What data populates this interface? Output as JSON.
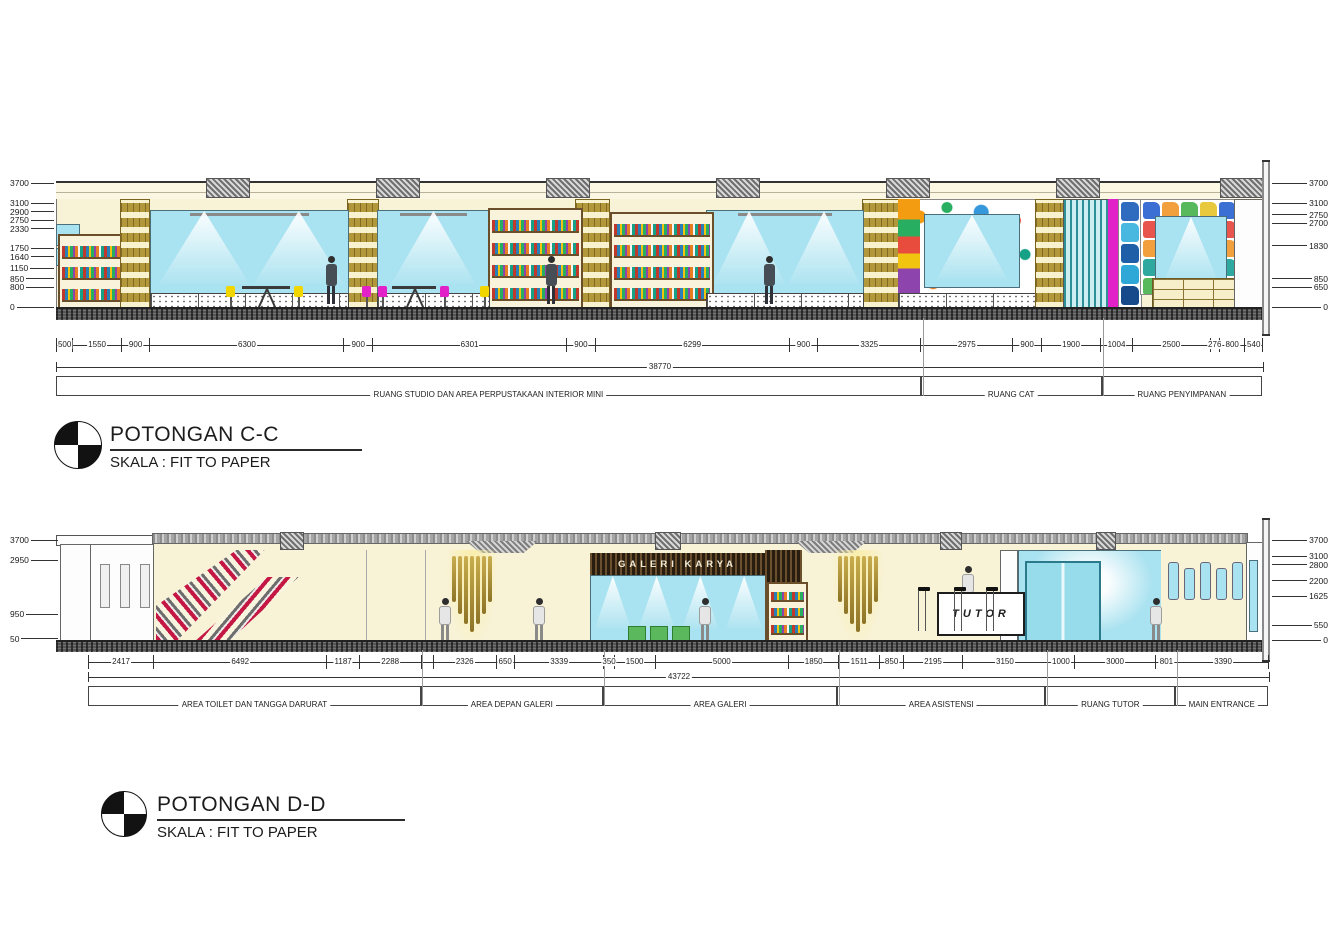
{
  "palette": {
    "cream": "#f8f3d7",
    "glass": "#a9e2f0",
    "gold": "#b2973b",
    "wood_dark": "#3f2f1c",
    "magenta": "#e321c8",
    "yellow": "#f2d600",
    "teal": "#2e8f96",
    "crimson": "#c41744",
    "green": "#5cb85c"
  },
  "storage_palette": [
    "#3b6fd4",
    "#e8554d",
    "#f2a03d",
    "#2fa8a0",
    "#58b85c",
    "#5a6b8c",
    "#e8c93d",
    "#c75db8"
  ],
  "side_tile_palette": [
    "#2f6bbf",
    "#49b8e0",
    "#1e5fa8",
    "#2fa8d8",
    "#164a8a"
  ],
  "section_c": {
    "title": "POTONGAN C-C",
    "scale_label": "SKALA : FIT TO PAPER",
    "levels_left": [
      3700,
      3100,
      2900,
      2750,
      2330,
      1750,
      1640,
      1150,
      850,
      800,
      0
    ],
    "levels_right": [
      3700,
      3100,
      2750,
      2700,
      1830,
      850,
      650,
      0
    ],
    "dims": [
      {
        "label": "500",
        "mm": 500
      },
      {
        "label": "1550",
        "mm": 1550
      },
      {
        "label": "900",
        "mm": 900
      },
      {
        "label": "6300",
        "mm": 6300
      },
      {
        "label": "900",
        "mm": 900
      },
      {
        "label": "6301",
        "mm": 6301
      },
      {
        "label": "900",
        "mm": 900
      },
      {
        "label": "6299",
        "mm": 6299
      },
      {
        "label": "900",
        "mm": 900
      },
      {
        "label": "3325",
        "mm": 3325
      },
      {
        "label": "2975",
        "mm": 2975
      },
      {
        "label": "900",
        "mm": 900
      },
      {
        "label": "1900",
        "mm": 1900
      },
      {
        "label": "1004",
        "mm": 1004
      },
      {
        "label": "2500",
        "mm": 2500
      },
      {
        "label": "276",
        "mm": 276
      },
      {
        "label": "800",
        "mm": 800
      },
      {
        "label": "540",
        "mm": 540
      }
    ],
    "total": "38770",
    "rooms": [
      {
        "label": "RUANG STUDIO DAN AREA PERPUSTAKAAN INTERIOR MINI",
        "span": 27875
      },
      {
        "label": "RUANG CAT",
        "span": 5775
      },
      {
        "label": "RUANG PENYIMPANAN",
        "span": 5120
      }
    ]
  },
  "section_d": {
    "title": "POTONGAN D-D",
    "scale_label": "SKALA : FIT TO PAPER",
    "gallery_sign": "GALERI KARYA",
    "tutor_sign": "TUTOR",
    "levels_left": [
      3700,
      2950,
      950,
      50
    ],
    "levels_right": [
      3700,
      3100,
      2800,
      2200,
      1625,
      550,
      0
    ],
    "dims": [
      {
        "label": "2417",
        "mm": 2417
      },
      {
        "label": "6492",
        "mm": 6492
      },
      {
        "label": "1187",
        "mm": 1187
      },
      {
        "label": "2288",
        "mm": 2288
      },
      {
        "label": "",
        "mm": 426
      },
      {
        "label": "2326",
        "mm": 2326
      },
      {
        "label": "650",
        "mm": 650
      },
      {
        "label": "3339",
        "mm": 3339
      },
      {
        "label": "350",
        "mm": 350
      },
      {
        "label": "1500",
        "mm": 1500
      },
      {
        "label": "5000",
        "mm": 5000
      },
      {
        "label": "1850",
        "mm": 1850
      },
      {
        "label": "1511",
        "mm": 1511
      },
      {
        "label": "850",
        "mm": 850
      },
      {
        "label": "2195",
        "mm": 2195
      },
      {
        "label": "3150",
        "mm": 3150
      },
      {
        "label": "1000",
        "mm": 1000
      },
      {
        "label": "3000",
        "mm": 3000
      },
      {
        "label": "801",
        "mm": 801
      },
      {
        "label": "3390",
        "mm": 3390
      }
    ],
    "total": "43722",
    "rooms": [
      {
        "label": "AREA TOILET DAN TANGGA DARURAT",
        "span": 12384
      },
      {
        "label": "AREA DEPAN GALERI",
        "span": 6741
      },
      {
        "label": "AREA GALERI",
        "span": 8700
      },
      {
        "label": "AREA ASISTENSI",
        "span": 7706
      },
      {
        "label": "RUANG TUTOR",
        "span": 4801
      },
      {
        "label": "MAIN ENTRANCE",
        "span": 3390
      }
    ]
  }
}
